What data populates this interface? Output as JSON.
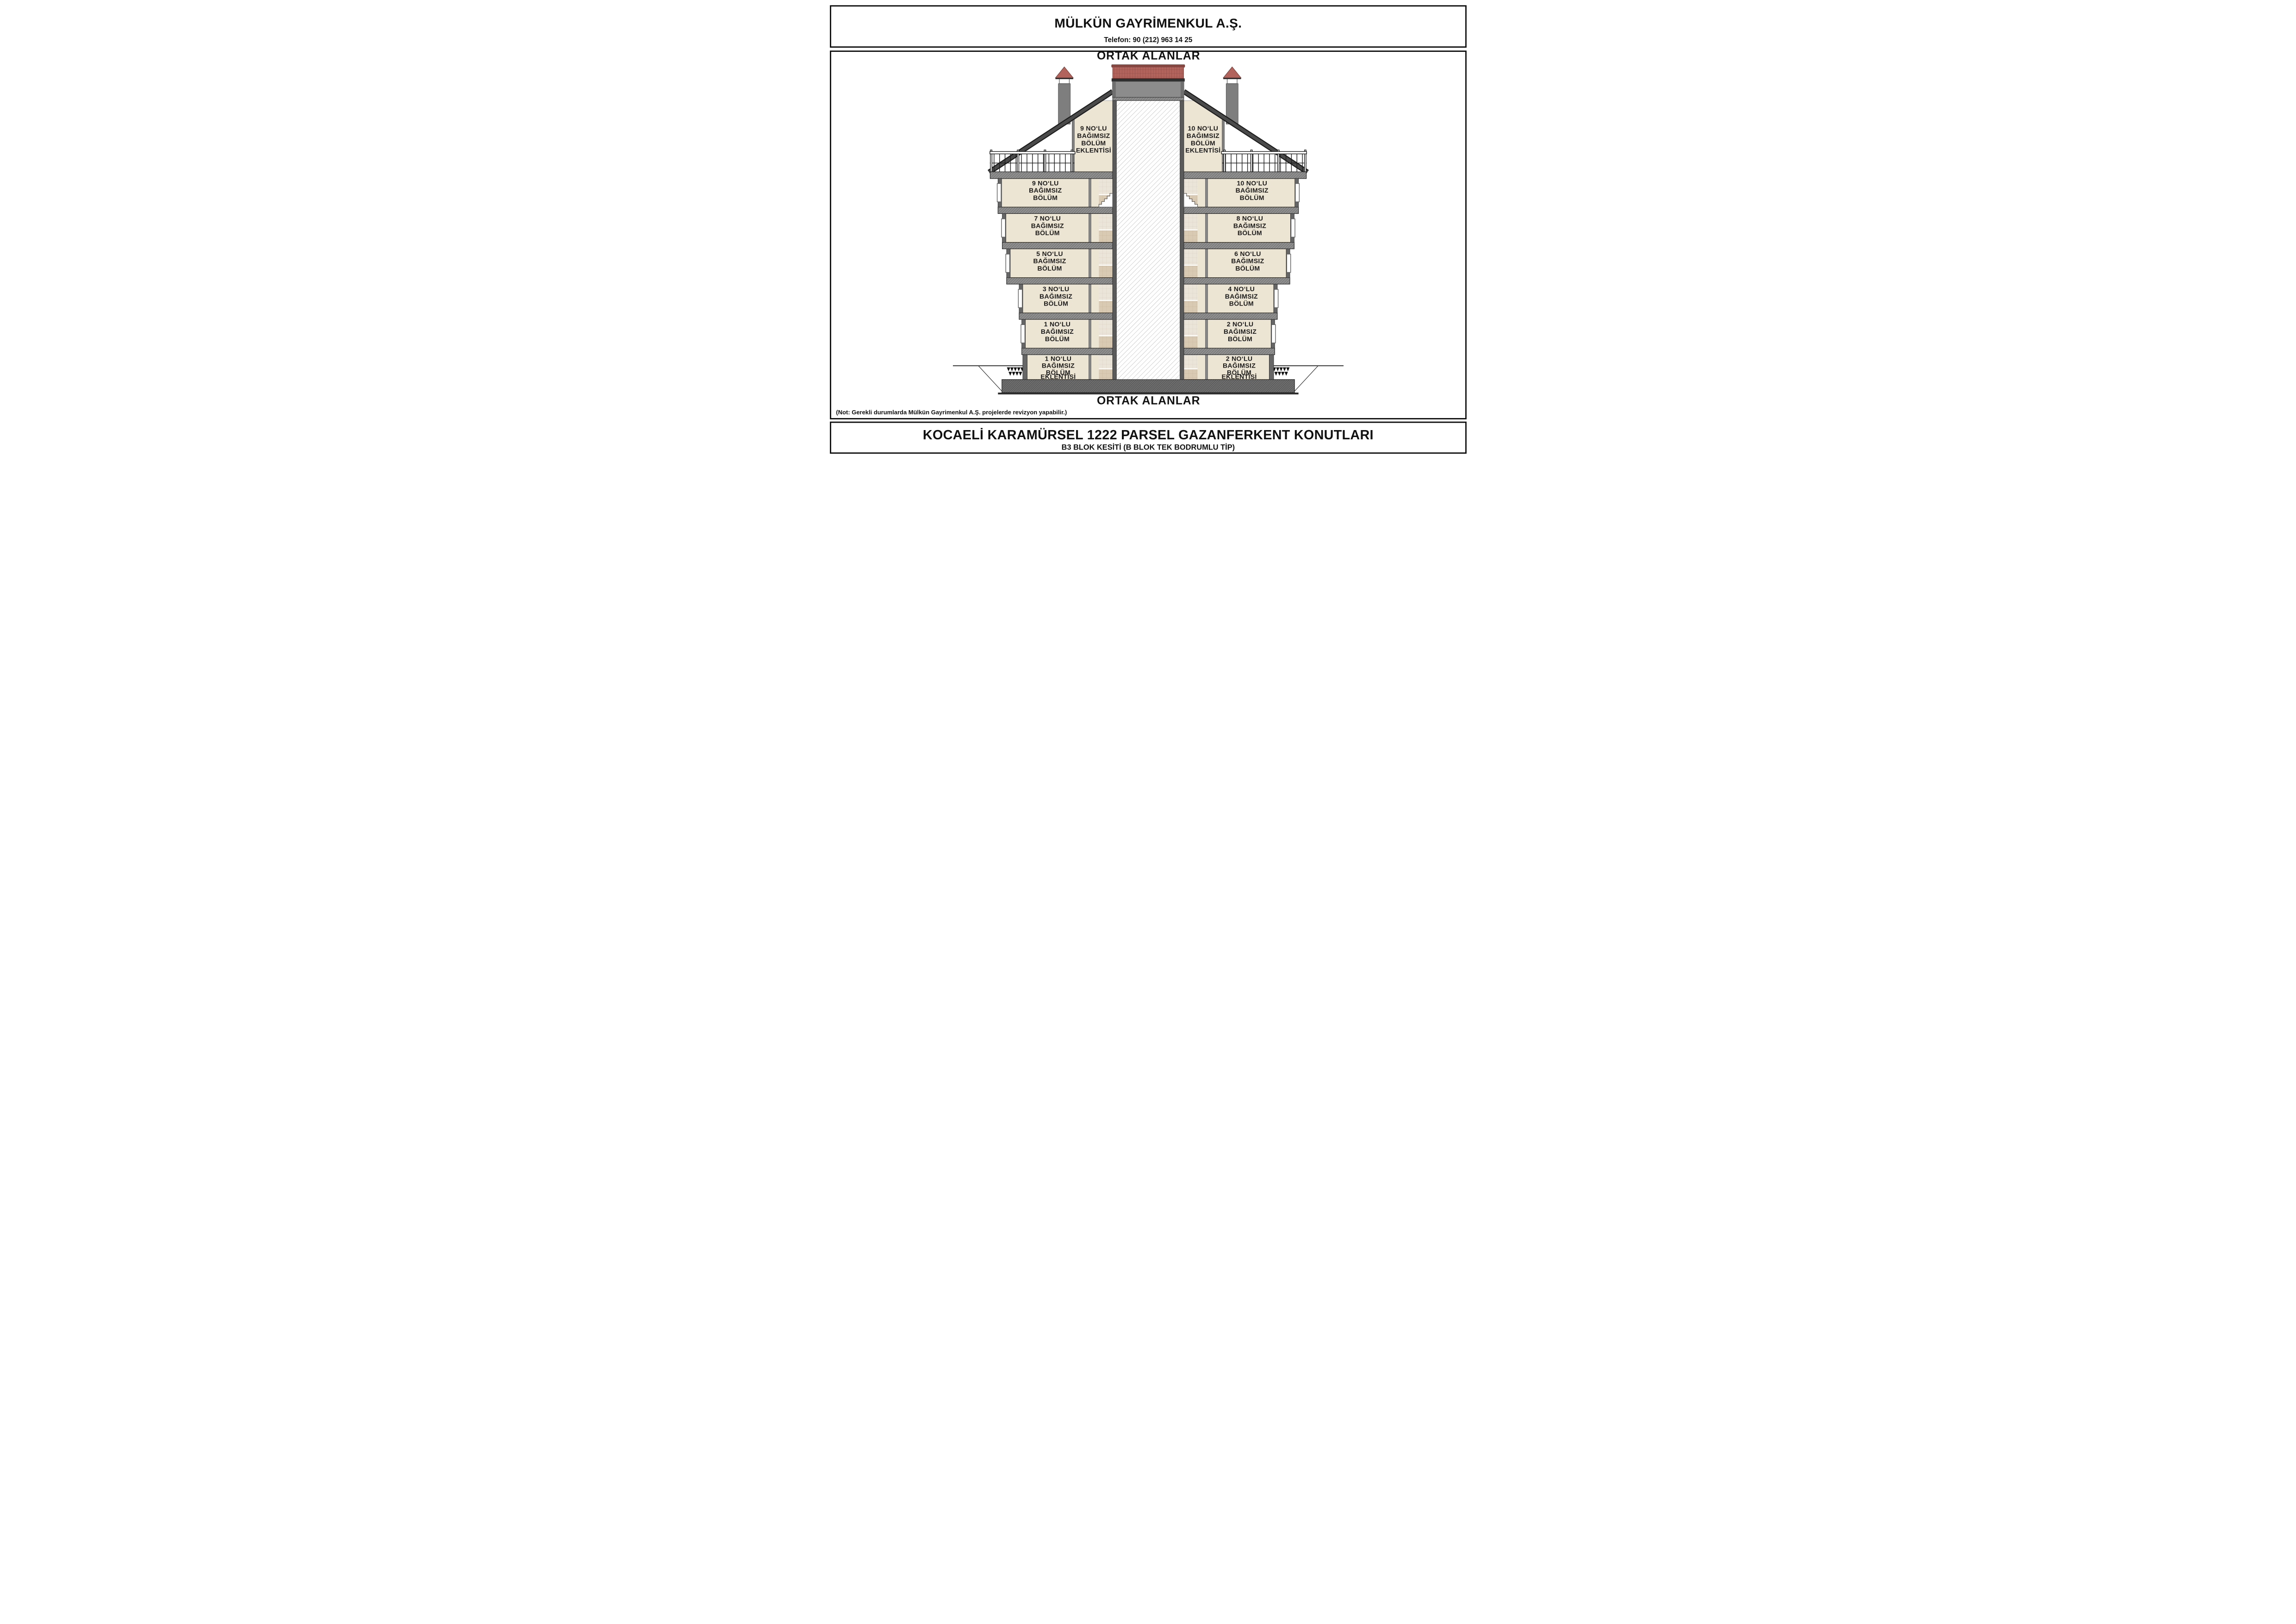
{
  "header": {
    "company": "MÜLKÜN GAYRİMENKUL A.Ş.",
    "phone": "Telefon: 90 (212) 963 14 25"
  },
  "drawing": {
    "common_area_top": "ORTAK ALANLAR",
    "common_area_bottom": "ORTAK ALANLAR",
    "note": "(Not: Gerekli durumlarda Mülkün Gayrimenkul A.Ş. projelerde revizyon yapabilir.)",
    "units": {
      "attic_left": [
        "9 NO‘LU",
        "BAĞIMSIZ",
        "BÖLÜM",
        "EKLENTİSİ"
      ],
      "attic_right": [
        "10 NO‘LU",
        "BAĞIMSIZ",
        "BÖLÜM",
        "EKLENTİSİ"
      ],
      "f9": [
        "9 NO‘LU",
        "BAĞIMSIZ",
        "BÖLÜM"
      ],
      "f10": [
        "10 NO‘LU",
        "BAĞIMSIZ",
        "BÖLÜM"
      ],
      "f7": [
        "7 NO‘LU",
        "BAĞIMSIZ",
        "BÖLÜM"
      ],
      "f8": [
        "8 NO‘LU",
        "BAĞIMSIZ",
        "BÖLÜM"
      ],
      "f5": [
        "5 NO‘LU",
        "BAĞIMSIZ",
        "BÖLÜM"
      ],
      "f6": [
        "6 NO‘LU",
        "BAĞIMSIZ",
        "BÖLÜM"
      ],
      "f3": [
        "3 NO‘LU",
        "BAĞIMSIZ",
        "BÖLÜM"
      ],
      "f4": [
        "4 NO‘LU",
        "BAĞIMSIZ",
        "BÖLÜM"
      ],
      "f1": [
        "1 NO‘LU",
        "BAĞIMSIZ",
        "BÖLÜM"
      ],
      "f2": [
        "2 NO‘LU",
        "BAĞIMSIZ",
        "BÖLÜM"
      ],
      "bsmt_left": [
        "1 NO‘LU",
        "BAĞIMSIZ",
        "BÖLÜM",
        "EKLENTİSİ"
      ],
      "bsmt_right": [
        "2 NO‘LU",
        "BAĞIMSIZ",
        "BÖLÜM",
        "EKLENTİSİ"
      ]
    }
  },
  "title_block": {
    "title": "KOCAELİ KARAMÜRSEL 1222 PARSEL GAZANFERKENT KONUTLARI",
    "subtitle": "B3 BLOK KESİTİ (B BLOK TEK BODRUMLU TİP)"
  },
  "colors": {
    "roof_red": "#b2635b",
    "roof_red_dark": "#8e4c45",
    "wall_gray": "#666666",
    "tower_gray": "#8c8c8c",
    "slab_gray": "#8f8f8f",
    "room_cream": "#ede5d3",
    "tile_light": "#ebe4d9",
    "tile_dark": "#d9cab4",
    "line_black": "#111111"
  }
}
